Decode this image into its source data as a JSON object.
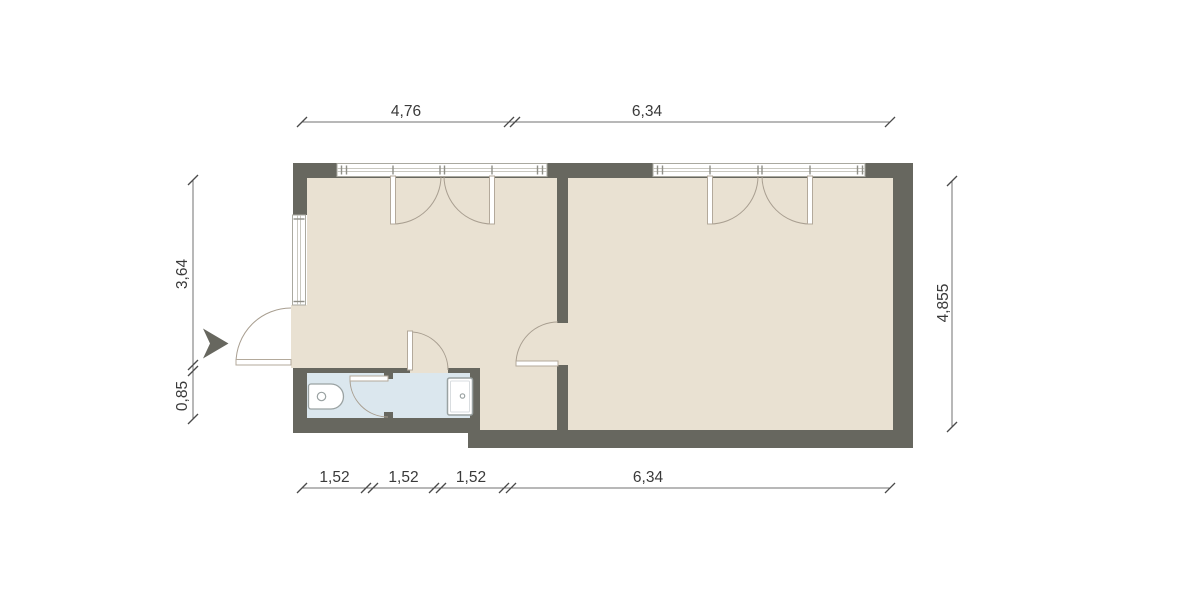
{
  "plan": {
    "dims": {
      "top": [
        "4,76",
        "6,34"
      ],
      "bottom": [
        "1,52",
        "1,52",
        "1,52",
        "6,34"
      ],
      "left": [
        "3,64",
        "0,85"
      ],
      "right": [
        "4,855"
      ]
    },
    "fixtures": [
      {
        "name": "toilet"
      },
      {
        "name": "shower-tray"
      }
    ],
    "icons": [
      {
        "name": "entrance-arrow"
      }
    ],
    "colors": {
      "wall": "#67675f",
      "floor": "#e9e1d2",
      "bathroom_floor": "#dbe7ee",
      "window_frame": "#aaa9a0",
      "door_arc": "#a89e90",
      "dimension_text": "#3a3a3a",
      "background": "#ffffff"
    }
  }
}
